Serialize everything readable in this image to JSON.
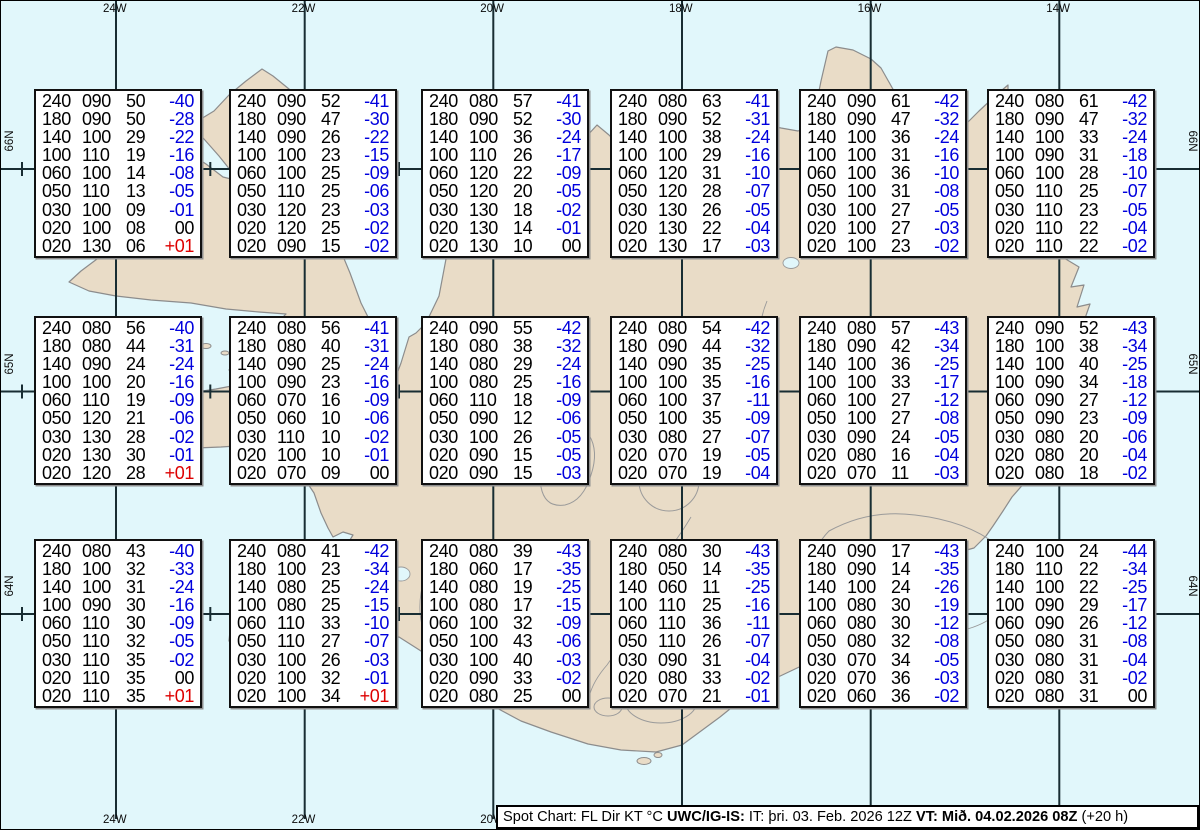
{
  "map": {
    "region_name": "Iceland spot chart",
    "top_lon_labels": [
      "24W",
      "22W",
      "20W",
      "18W",
      "16W",
      "14W"
    ],
    "bottom_lon_labels": [
      "24W",
      "22W",
      "20W"
    ],
    "left_lat_labels": [
      "66N",
      "65N",
      "64N"
    ],
    "right_lat_labels": [
      "66N",
      "65N",
      "64N"
    ],
    "colors": {
      "water": "#e1f7fb",
      "land": "#e9dcc7",
      "coastline": "#8c8c8c",
      "grid": "#182d33",
      "temp_negative": "#0000dd",
      "temp_positive": "#dd0000",
      "text": "#000000"
    }
  },
  "column_meaning": [
    "FL",
    "Dir",
    "KT",
    "°C"
  ],
  "boxes": {
    "66N": [
      [
        [
          "240",
          "090",
          "50",
          "-40"
        ],
        [
          "180",
          "090",
          "50",
          "-28"
        ],
        [
          "140",
          "100",
          "29",
          "-22"
        ],
        [
          "100",
          "110",
          "19",
          "-16"
        ],
        [
          "060",
          "100",
          "14",
          "-08"
        ],
        [
          "050",
          "110",
          "13",
          "-05"
        ],
        [
          "030",
          "100",
          "09",
          "-01"
        ],
        [
          "020",
          "100",
          "08",
          "00"
        ],
        [
          "020",
          "130",
          "06",
          "+01"
        ]
      ],
      [
        [
          "240",
          "090",
          "52",
          "-41"
        ],
        [
          "180",
          "090",
          "47",
          "-30"
        ],
        [
          "140",
          "090",
          "26",
          "-22"
        ],
        [
          "100",
          "100",
          "23",
          "-15"
        ],
        [
          "060",
          "100",
          "25",
          "-09"
        ],
        [
          "050",
          "110",
          "25",
          "-06"
        ],
        [
          "030",
          "120",
          "23",
          "-03"
        ],
        [
          "020",
          "120",
          "25",
          "-02"
        ],
        [
          "020",
          "090",
          "15",
          "-02"
        ]
      ],
      [
        [
          "240",
          "080",
          "57",
          "-41"
        ],
        [
          "180",
          "090",
          "52",
          "-30"
        ],
        [
          "140",
          "100",
          "36",
          "-24"
        ],
        [
          "100",
          "110",
          "26",
          "-17"
        ],
        [
          "060",
          "120",
          "22",
          "-09"
        ],
        [
          "050",
          "120",
          "20",
          "-05"
        ],
        [
          "030",
          "130",
          "18",
          "-02"
        ],
        [
          "020",
          "130",
          "14",
          "-01"
        ],
        [
          "020",
          "130",
          "10",
          "00"
        ]
      ],
      [
        [
          "240",
          "080",
          "63",
          "-41"
        ],
        [
          "180",
          "090",
          "52",
          "-31"
        ],
        [
          "140",
          "100",
          "38",
          "-24"
        ],
        [
          "100",
          "100",
          "29",
          "-16"
        ],
        [
          "060",
          "120",
          "31",
          "-10"
        ],
        [
          "050",
          "120",
          "28",
          "-07"
        ],
        [
          "030",
          "130",
          "26",
          "-05"
        ],
        [
          "020",
          "130",
          "22",
          "-04"
        ],
        [
          "020",
          "130",
          "17",
          "-03"
        ]
      ],
      [
        [
          "240",
          "090",
          "61",
          "-42"
        ],
        [
          "180",
          "090",
          "47",
          "-32"
        ],
        [
          "140",
          "100",
          "36",
          "-24"
        ],
        [
          "100",
          "100",
          "31",
          "-16"
        ],
        [
          "060",
          "100",
          "36",
          "-10"
        ],
        [
          "050",
          "100",
          "31",
          "-08"
        ],
        [
          "030",
          "100",
          "27",
          "-05"
        ],
        [
          "020",
          "100",
          "27",
          "-03"
        ],
        [
          "020",
          "100",
          "23",
          "-02"
        ]
      ],
      [
        [
          "240",
          "080",
          "61",
          "-42"
        ],
        [
          "180",
          "090",
          "47",
          "-32"
        ],
        [
          "140",
          "100",
          "33",
          "-24"
        ],
        [
          "100",
          "090",
          "31",
          "-18"
        ],
        [
          "060",
          "100",
          "28",
          "-10"
        ],
        [
          "050",
          "110",
          "25",
          "-07"
        ],
        [
          "030",
          "110",
          "23",
          "-05"
        ],
        [
          "020",
          "110",
          "22",
          "-04"
        ],
        [
          "020",
          "110",
          "22",
          "-02"
        ]
      ]
    ],
    "65N": [
      [
        [
          "240",
          "080",
          "56",
          "-40"
        ],
        [
          "180",
          "080",
          "44",
          "-31"
        ],
        [
          "140",
          "090",
          "24",
          "-24"
        ],
        [
          "100",
          "100",
          "20",
          "-16"
        ],
        [
          "060",
          "110",
          "19",
          "-09"
        ],
        [
          "050",
          "120",
          "21",
          "-06"
        ],
        [
          "030",
          "130",
          "28",
          "-02"
        ],
        [
          "020",
          "130",
          "30",
          "-01"
        ],
        [
          "020",
          "120",
          "28",
          "+01"
        ]
      ],
      [
        [
          "240",
          "080",
          "56",
          "-41"
        ],
        [
          "180",
          "080",
          "40",
          "-31"
        ],
        [
          "140",
          "090",
          "25",
          "-24"
        ],
        [
          "100",
          "090",
          "23",
          "-16"
        ],
        [
          "060",
          "070",
          "16",
          "-09"
        ],
        [
          "050",
          "060",
          "10",
          "-06"
        ],
        [
          "030",
          "110",
          "10",
          "-02"
        ],
        [
          "020",
          "100",
          "10",
          "-01"
        ],
        [
          "020",
          "070",
          "09",
          "00"
        ]
      ],
      [
        [
          "240",
          "090",
          "55",
          "-42"
        ],
        [
          "180",
          "080",
          "38",
          "-32"
        ],
        [
          "140",
          "080",
          "29",
          "-24"
        ],
        [
          "100",
          "080",
          "25",
          "-16"
        ],
        [
          "060",
          "110",
          "18",
          "-09"
        ],
        [
          "050",
          "090",
          "12",
          "-06"
        ],
        [
          "030",
          "100",
          "26",
          "-05"
        ],
        [
          "020",
          "090",
          "15",
          "-05"
        ],
        [
          "020",
          "090",
          "15",
          "-03"
        ]
      ],
      [
        [
          "240",
          "080",
          "54",
          "-42"
        ],
        [
          "180",
          "090",
          "44",
          "-32"
        ],
        [
          "140",
          "090",
          "35",
          "-25"
        ],
        [
          "100",
          "100",
          "35",
          "-16"
        ],
        [
          "060",
          "100",
          "37",
          "-11"
        ],
        [
          "050",
          "100",
          "35",
          "-09"
        ],
        [
          "030",
          "080",
          "27",
          "-07"
        ],
        [
          "020",
          "070",
          "19",
          "-05"
        ],
        [
          "020",
          "070",
          "19",
          "-04"
        ]
      ],
      [
        [
          "240",
          "080",
          "57",
          "-43"
        ],
        [
          "180",
          "090",
          "42",
          "-34"
        ],
        [
          "140",
          "100",
          "36",
          "-25"
        ],
        [
          "100",
          "100",
          "33",
          "-17"
        ],
        [
          "060",
          "100",
          "27",
          "-12"
        ],
        [
          "050",
          "100",
          "27",
          "-08"
        ],
        [
          "030",
          "090",
          "24",
          "-05"
        ],
        [
          "020",
          "080",
          "16",
          "-04"
        ],
        [
          "020",
          "070",
          "11",
          "-03"
        ]
      ],
      [
        [
          "240",
          "090",
          "52",
          "-43"
        ],
        [
          "180",
          "100",
          "38",
          "-34"
        ],
        [
          "140",
          "100",
          "40",
          "-25"
        ],
        [
          "100",
          "090",
          "34",
          "-18"
        ],
        [
          "060",
          "090",
          "27",
          "-12"
        ],
        [
          "050",
          "090",
          "23",
          "-09"
        ],
        [
          "030",
          "080",
          "20",
          "-06"
        ],
        [
          "020",
          "080",
          "20",
          "-04"
        ],
        [
          "020",
          "080",
          "18",
          "-02"
        ]
      ]
    ],
    "64N": [
      [
        [
          "240",
          "080",
          "43",
          "-40"
        ],
        [
          "180",
          "100",
          "32",
          "-33"
        ],
        [
          "140",
          "100",
          "31",
          "-24"
        ],
        [
          "100",
          "090",
          "30",
          "-16"
        ],
        [
          "060",
          "110",
          "30",
          "-09"
        ],
        [
          "050",
          "110",
          "32",
          "-05"
        ],
        [
          "030",
          "110",
          "35",
          "-02"
        ],
        [
          "020",
          "110",
          "35",
          "00"
        ],
        [
          "020",
          "110",
          "35",
          "+01"
        ]
      ],
      [
        [
          "240",
          "080",
          "41",
          "-42"
        ],
        [
          "180",
          "100",
          "23",
          "-34"
        ],
        [
          "140",
          "080",
          "25",
          "-24"
        ],
        [
          "100",
          "080",
          "25",
          "-15"
        ],
        [
          "060",
          "110",
          "33",
          "-10"
        ],
        [
          "050",
          "110",
          "27",
          "-07"
        ],
        [
          "030",
          "100",
          "26",
          "-03"
        ],
        [
          "020",
          "100",
          "32",
          "-01"
        ],
        [
          "020",
          "100",
          "34",
          "+01"
        ]
      ],
      [
        [
          "240",
          "080",
          "39",
          "-43"
        ],
        [
          "180",
          "060",
          "17",
          "-35"
        ],
        [
          "140",
          "080",
          "19",
          "-25"
        ],
        [
          "100",
          "080",
          "17",
          "-15"
        ],
        [
          "060",
          "100",
          "32",
          "-09"
        ],
        [
          "050",
          "100",
          "43",
          "-06"
        ],
        [
          "030",
          "100",
          "40",
          "-03"
        ],
        [
          "020",
          "090",
          "33",
          "-02"
        ],
        [
          "020",
          "080",
          "25",
          "00"
        ]
      ],
      [
        [
          "240",
          "080",
          "30",
          "-43"
        ],
        [
          "180",
          "050",
          "14",
          "-35"
        ],
        [
          "140",
          "060",
          "11",
          "-25"
        ],
        [
          "100",
          "110",
          "25",
          "-16"
        ],
        [
          "060",
          "110",
          "36",
          "-11"
        ],
        [
          "050",
          "110",
          "26",
          "-07"
        ],
        [
          "030",
          "090",
          "31",
          "-04"
        ],
        [
          "020",
          "080",
          "33",
          "-02"
        ],
        [
          "020",
          "070",
          "21",
          "-01"
        ]
      ],
      [
        [
          "240",
          "090",
          "17",
          "-43"
        ],
        [
          "180",
          "090",
          "14",
          "-35"
        ],
        [
          "140",
          "100",
          "24",
          "-26"
        ],
        [
          "100",
          "080",
          "30",
          "-19"
        ],
        [
          "060",
          "080",
          "30",
          "-12"
        ],
        [
          "050",
          "080",
          "32",
          "-08"
        ],
        [
          "030",
          "070",
          "34",
          "-05"
        ],
        [
          "020",
          "070",
          "36",
          "-03"
        ],
        [
          "020",
          "060",
          "36",
          "-02"
        ]
      ],
      [
        [
          "240",
          "100",
          "24",
          "-44"
        ],
        [
          "180",
          "110",
          "22",
          "-34"
        ],
        [
          "140",
          "100",
          "22",
          "-25"
        ],
        [
          "100",
          "090",
          "29",
          "-17"
        ],
        [
          "060",
          "090",
          "26",
          "-12"
        ],
        [
          "050",
          "080",
          "31",
          "-08"
        ],
        [
          "030",
          "080",
          "31",
          "-04"
        ],
        [
          "020",
          "080",
          "31",
          "-02"
        ],
        [
          "020",
          "080",
          "31",
          "00"
        ]
      ]
    ]
  },
  "footer": {
    "title": "Spot Chart: FL Dir KT °C ",
    "source": "UWC/IG-IS:",
    "issue": " IT: þri. 03. Feb. 2026 12Z ",
    "valid": "VT: Mið. 04.02.2026 08Z",
    "offset": " (+20 h)"
  }
}
